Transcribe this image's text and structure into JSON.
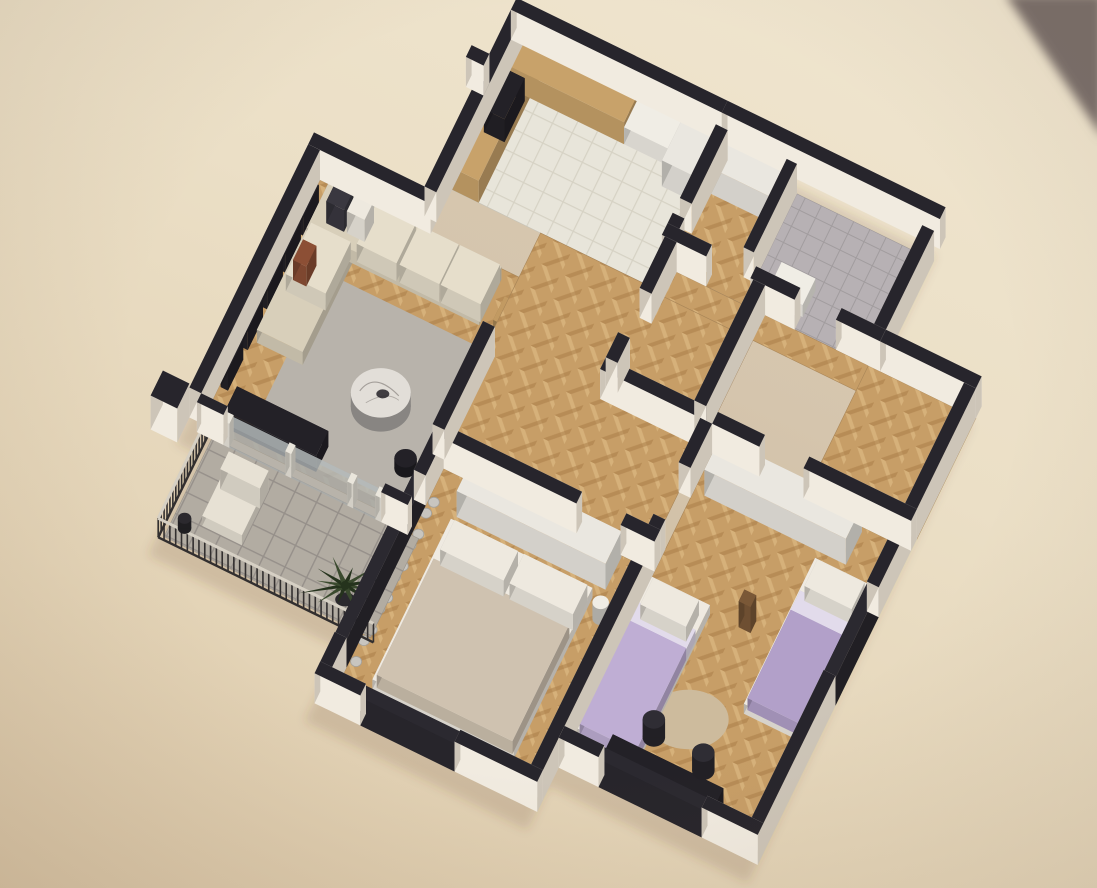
{
  "meta": {
    "visible_text": []
  },
  "palette": {
    "cornerDark": "#796e6a",
    "shadowFill": "rgba(96,70,40,0.16)",
    "wallTop": "#27252c",
    "wallSideL": "#f1ebe0",
    "wallSideD": "#cdc5b8",
    "wood": "#c79e67",
    "woodLight": "#d9b57e",
    "woodDark": "#a97e49",
    "tileKitchen": "#e8e5da",
    "tileKitchenLine": "#d6d2c4",
    "tileBalcony": "#b2aca2",
    "tileBalconyLine": "#96908a",
    "bathFloor": "#b7b1b4",
    "mosaicDark": "#45414a",
    "mosaicLight": "#9b95a0",
    "rug": "#b8b3ab",
    "rugKids": "#cdbb9d",
    "sofa": "#d8cfba",
    "sofaLight": "#e6decb",
    "pillowDark": "#3a3840",
    "pillowWhite": "#eee9df",
    "pillowRust": "#8c4f35",
    "marble": "#e2ded8",
    "marbleVein": "#8a8580",
    "tableWhite": "#f0ede5",
    "chairRattan": "#c29a62",
    "woodCab": "#c8a26a",
    "wardrobe": "#eae7e0",
    "bedSheet": "#efeae1",
    "bedMaster": "#cfc2b0",
    "lilac": "#b2a0c9",
    "lilac2": "#bfaed4",
    "bedKidsBand": "#e2dbeb",
    "curtain": "#c8c5bf",
    "darkFurn": "#232127",
    "chairOffice": "#2f2d34",
    "plantGreen": "#3a4a2e",
    "plantDark": "#25331d",
    "potDark": "#2b292e",
    "lounge": "#e7e1d4",
    "railPost": "#322f2f",
    "railTop": "#d6d0c4",
    "glassFrame": "#2b2930",
    "glassPane": "#b9bfc0",
    "mullion": "#eae6dc",
    "valetBrown": "#7a5837"
  },
  "rooms": [
    {
      "id": "scene",
      "name": "scene"
    },
    {
      "id": "living-room",
      "name": "living-room"
    },
    {
      "id": "dining-area",
      "name": "dining-area"
    },
    {
      "id": "kitchen",
      "name": "kitchen"
    },
    {
      "id": "entry-hall",
      "name": "entry-hall"
    },
    {
      "id": "wc",
      "name": "wc"
    },
    {
      "id": "bathroom",
      "name": "bathroom"
    },
    {
      "id": "hallway",
      "name": "hallway"
    },
    {
      "id": "master-bedroom",
      "name": "master-bedroom"
    },
    {
      "id": "kids-bedroom",
      "name": "kids-bedroom"
    },
    {
      "id": "balcony",
      "name": "balcony"
    },
    {
      "id": "walls",
      "name": "walls"
    }
  ],
  "elements": [
    {
      "id": "photo-corner",
      "name": "photo-background-corner",
      "room": "scene",
      "fill": "cornerDark"
    },
    {
      "id": "building-shadow",
      "name": "building-drop-shadow",
      "room": "scene",
      "fill": "shadowFill"
    },
    {
      "id": "floor-living",
      "name": "living-room-floor",
      "room": "living-room",
      "fill": "wood"
    },
    {
      "id": "floor-hall",
      "name": "hallway-floor",
      "room": "hallway",
      "fill": "wood"
    },
    {
      "id": "floor-hall-upper",
      "name": "upper-hall-floor",
      "room": "hallway",
      "fill": "wood"
    },
    {
      "id": "floor-vestibule",
      "name": "vestibule-floor",
      "room": "hallway",
      "fill": "wood"
    },
    {
      "id": "floor-kitchen",
      "name": "kitchen-floor",
      "room": "kitchen",
      "fill": "tileKitchen"
    },
    {
      "id": "floor-entry-closet",
      "name": "entry-closet-floor",
      "room": "entry-hall",
      "fill": "wood"
    },
    {
      "id": "floor-entry-wc",
      "name": "wc-floor",
      "room": "wc",
      "fill": "bathFloor"
    },
    {
      "id": "floor-bathroom",
      "name": "bathroom-floor",
      "room": "bathroom",
      "fill": "bathFloor"
    },
    {
      "id": "floor-shower",
      "name": "shower-mosaic-floor",
      "room": "bathroom",
      "fill": "mosaicDark"
    },
    {
      "id": "floor-master",
      "name": "master-bedroom-floor",
      "room": "master-bedroom",
      "fill": "wood"
    },
    {
      "id": "floor-kids",
      "name": "kids-bedroom-floor",
      "room": "kids-bedroom",
      "fill": "wood"
    },
    {
      "id": "floor-balcony",
      "name": "balcony-floor",
      "room": "balcony",
      "fill": "tileBalcony"
    },
    {
      "id": "balcony-railing",
      "name": "balcony-railing",
      "room": "balcony",
      "fill": "railPost"
    },
    {
      "id": "lounge-chair-base",
      "name": "balcony-lounge-chair",
      "room": "balcony",
      "fill": "lounge"
    },
    {
      "id": "lounge-chair-back",
      "name": "balcony-lounge-chair-back",
      "room": "balcony",
      "fill": "lounge"
    },
    {
      "id": "balcony-pot",
      "name": "balcony-plant-pot",
      "room": "balcony",
      "fill": "potDark"
    },
    {
      "id": "palm-plant",
      "name": "palm-plant",
      "room": "balcony",
      "fill": "plantGreen"
    },
    {
      "id": "living-rug",
      "name": "living-room-rug",
      "room": "living-room",
      "fill": "rug"
    },
    {
      "id": "gallery-shelf-1",
      "name": "wall-gallery-shelf",
      "room": "living-room",
      "fill": "darkFurn"
    },
    {
      "id": "gallery-shelf-2",
      "name": "wall-gallery-shelf",
      "room": "living-room",
      "fill": "darkFurn"
    },
    {
      "id": "gallery-shelf-3",
      "name": "wall-gallery-shelf",
      "room": "living-room",
      "fill": "darkFurn"
    },
    {
      "id": "gallery-shelf-4",
      "name": "wall-gallery-shelf",
      "room": "living-room",
      "fill": "darkFurn"
    },
    {
      "id": "gallery-shelf-5",
      "name": "wall-gallery-shelf",
      "room": "living-room",
      "fill": "darkFurn"
    },
    {
      "id": "sofa-chaise",
      "name": "sofa-chaise",
      "room": "living-room",
      "fill": "sofa"
    },
    {
      "id": "sofa-main",
      "name": "sofa",
      "room": "living-room",
      "fill": "sofa"
    },
    {
      "id": "sofa-cushion-1",
      "name": "sofa-cushion",
      "room": "living-room",
      "fill": "sofaLight"
    },
    {
      "id": "sofa-cushion-2",
      "name": "sofa-cushion",
      "room": "living-room",
      "fill": "sofaLight"
    },
    {
      "id": "sofa-cushion-3",
      "name": "sofa-cushion",
      "room": "living-room",
      "fill": "sofaLight"
    },
    {
      "id": "sofa-cushion-4",
      "name": "sofa-cushion",
      "room": "living-room",
      "fill": "sofaLight"
    },
    {
      "id": "pillow-dark",
      "name": "throw-pillow-dark",
      "room": "living-room",
      "fill": "pillowDark"
    },
    {
      "id": "pillow-white",
      "name": "throw-pillow-white",
      "room": "living-room",
      "fill": "pillowWhite"
    },
    {
      "id": "pillow-rust",
      "name": "throw-pillow-rust",
      "room": "living-room",
      "fill": "pillowRust"
    },
    {
      "id": "coffee-table-marble",
      "name": "round-marble-coffee-table",
      "room": "living-room",
      "fill": "marble"
    },
    {
      "id": "side-table",
      "name": "side-table",
      "room": "living-room",
      "fill": "darkFurn"
    },
    {
      "id": "tv-console",
      "name": "tv-console",
      "room": "living-room",
      "fill": "darkFurn"
    },
    {
      "id": "dining-table",
      "name": "dining-table",
      "room": "dining-area",
      "fill": "tableWhite"
    },
    {
      "id": "dining-chair-1",
      "name": "dining-chair",
      "room": "dining-area",
      "fill": "chairRattan"
    },
    {
      "id": "dining-chair-2",
      "name": "dining-chair",
      "room": "dining-area",
      "fill": "chairRattan"
    },
    {
      "id": "dining-chair-3",
      "name": "dining-chair",
      "room": "dining-area",
      "fill": "chairRattan"
    },
    {
      "id": "dining-chair-4",
      "name": "dining-chair",
      "room": "dining-area",
      "fill": "chairRattan"
    },
    {
      "id": "dining-decor",
      "name": "table-centerpiece",
      "room": "dining-area",
      "fill": "woodCab"
    },
    {
      "id": "tv-screen",
      "name": "wall-tv",
      "room": "dining-area",
      "fill": "darkFurn"
    },
    {
      "id": "kitchen-cabinet-left",
      "name": "kitchen-cabinets",
      "room": "kitchen",
      "fill": "woodCab"
    },
    {
      "id": "kitchen-cabinet-top",
      "name": "kitchen-cabinets",
      "room": "kitchen",
      "fill": "woodCab"
    },
    {
      "id": "kitchen-counter",
      "name": "kitchen-counter",
      "room": "kitchen",
      "fill": "tableWhite"
    },
    {
      "id": "kitchen-tall-cabinet",
      "name": "kitchen-tall-cabinet",
      "room": "kitchen",
      "fill": "wardrobe"
    },
    {
      "id": "kitchen-cooktop",
      "name": "kitchen-cooktop",
      "room": "kitchen",
      "fill": "darkFurn"
    },
    {
      "id": "entry-wardrobe",
      "name": "entry-wardrobe",
      "room": "entry-hall",
      "fill": "wardrobe"
    },
    {
      "id": "entry-wc-fixture",
      "name": "wc-fixture",
      "room": "wc",
      "fill": "tableWhite"
    },
    {
      "id": "shower-partition",
      "name": "shower-glass-partition",
      "room": "bathroom",
      "fill": "glassPane"
    },
    {
      "id": "toilet",
      "name": "toilet",
      "room": "bathroom",
      "fill": "tableWhite"
    },
    {
      "id": "bathroom-vanity",
      "name": "bathroom-vanity",
      "room": "bathroom",
      "fill": "tableWhite"
    },
    {
      "id": "master-wardrobe",
      "name": "master-wardrobe",
      "room": "master-bedroom",
      "fill": "wardrobe"
    },
    {
      "id": "master-bed-base",
      "name": "double-bed",
      "room": "master-bedroom",
      "fill": "bedSheet"
    },
    {
      "id": "master-bed-blanket",
      "name": "double-bed-blanket",
      "room": "master-bedroom",
      "fill": "bedMaster"
    },
    {
      "id": "master-pillow-1",
      "name": "bed-pillow",
      "room": "master-bedroom",
      "fill": "pillowWhite"
    },
    {
      "id": "master-pillow-2",
      "name": "bed-pillow",
      "room": "master-bedroom",
      "fill": "pillowWhite"
    },
    {
      "id": "master-bedside-lamp",
      "name": "bedside-lamp",
      "room": "master-bedroom",
      "fill": "tableWhite"
    },
    {
      "id": "master-curtains",
      "name": "window-curtains",
      "room": "master-bedroom",
      "fill": "curtain"
    },
    {
      "id": "kids-rug",
      "name": "kids-round-rug",
      "room": "kids-bedroom",
      "fill": "rugKids"
    },
    {
      "id": "kids-wardrobe",
      "name": "kids-wardrobe",
      "room": "kids-bedroom",
      "fill": "wardrobe"
    },
    {
      "id": "kids-bed-right-base",
      "name": "single-bed",
      "room": "kids-bedroom",
      "fill": "bedSheet"
    },
    {
      "id": "kids-bed-right-band",
      "name": "single-bed-sheet-band",
      "room": "kids-bedroom",
      "fill": "bedKidsBand"
    },
    {
      "id": "kids-bed-right-blanket",
      "name": "single-bed-blanket-lilac",
      "room": "kids-bedroom",
      "fill": "lilac"
    },
    {
      "id": "kids-bed-right-pillow",
      "name": "bed-pillow",
      "room": "kids-bedroom",
      "fill": "pillowWhite"
    },
    {
      "id": "kids-bed-left-base",
      "name": "single-bed",
      "room": "kids-bedroom",
      "fill": "bedSheet"
    },
    {
      "id": "kids-bed-left-band",
      "name": "single-bed-sheet-band",
      "room": "kids-bedroom",
      "fill": "bedKidsBand"
    },
    {
      "id": "kids-bed-left-blanket",
      "name": "single-bed-blanket-lilac",
      "room": "kids-bedroom",
      "fill": "lilac2"
    },
    {
      "id": "kids-bed-left-pillow",
      "name": "bed-pillow",
      "room": "kids-bedroom",
      "fill": "pillowWhite"
    },
    {
      "id": "kids-desk",
      "name": "desk",
      "room": "kids-bedroom",
      "fill": "darkFurn"
    },
    {
      "id": "kids-chair-1",
      "name": "office-chair",
      "room": "kids-bedroom",
      "fill": "chairOffice"
    },
    {
      "id": "kids-chair-2",
      "name": "office-chair",
      "room": "kids-bedroom",
      "fill": "chairOffice"
    },
    {
      "id": "kids-valet",
      "name": "valet-stand",
      "room": "kids-bedroom",
      "fill": "valetBrown"
    },
    {
      "id": "window-kids-right",
      "name": "window",
      "room": "walls",
      "fill": "glassFrame"
    },
    {
      "id": "window-master-left",
      "name": "window",
      "room": "walls",
      "fill": "glassFrame"
    },
    {
      "id": "window-master-bottom",
      "name": "window",
      "room": "walls",
      "fill": "glassFrame"
    },
    {
      "id": "window-kids-desk",
      "name": "window",
      "room": "walls",
      "fill": "glassFrame"
    },
    {
      "id": "glass-door-pane",
      "name": "balcony-sliding-glass-door",
      "room": "walls",
      "fill": "glassPane"
    },
    {
      "id": "glass-door-mullion-1",
      "name": "glass-door-mullion",
      "room": "walls",
      "fill": "mullion"
    },
    {
      "id": "glass-door-mullion-2",
      "name": "glass-door-mullion",
      "room": "walls",
      "fill": "mullion"
    },
    {
      "id": "glass-door-mullion-3",
      "name": "glass-door-mullion",
      "room": "walls",
      "fill": "mullion"
    },
    {
      "id": "glass-door-mullion-4",
      "name": "glass-door-mullion",
      "room": "walls",
      "fill": "mullion"
    },
    {
      "id": "wall-living-top",
      "name": "exterior-wall",
      "room": "walls",
      "fill": "wallTop"
    },
    {
      "id": "wall-living-left",
      "name": "exterior-wall",
      "room": "walls",
      "fill": "wallTop"
    },
    {
      "id": "wall-kitchen-left",
      "name": "exterior-wall",
      "room": "walls",
      "fill": "wallTop"
    },
    {
      "id": "wall-kitchen-stub",
      "name": "exterior-wall-stub",
      "room": "walls",
      "fill": "wallTop"
    },
    {
      "id": "wall-kitchen-top",
      "name": "exterior-wall",
      "room": "walls",
      "fill": "wallTop"
    },
    {
      "id": "wall-entry-top",
      "name": "exterior-wall",
      "room": "walls",
      "fill": "wallTop"
    },
    {
      "id": "wall-entry-left-a",
      "name": "interior-wall",
      "room": "walls",
      "fill": "wallTop"
    },
    {
      "id": "wall-entry-left-b",
      "name": "interior-wall",
      "room": "walls",
      "fill": "wallTop"
    },
    {
      "id": "wall-entry-divider",
      "name": "interior-wall",
      "room": "walls",
      "fill": "wallTop"
    },
    {
      "id": "wall-entry-right",
      "name": "exterior-wall",
      "room": "walls",
      "fill": "wallTop"
    },
    {
      "id": "wall-entry-band-1",
      "name": "interior-wall",
      "room": "walls",
      "fill": "wallTop"
    },
    {
      "id": "wall-entry-band-2",
      "name": "interior-wall",
      "room": "walls",
      "fill": "wallTop"
    },
    {
      "id": "wall-entry-band-3",
      "name": "interior-wall",
      "room": "walls",
      "fill": "wallTop"
    },
    {
      "id": "wall-vestibule-top",
      "name": "exterior-wall",
      "room": "walls",
      "fill": "wallTop"
    },
    {
      "id": "wall-right-upper",
      "name": "exterior-wall",
      "room": "walls",
      "fill": "wallTop"
    },
    {
      "id": "wall-right-lower",
      "name": "exterior-wall",
      "room": "walls",
      "fill": "wallTop"
    },
    {
      "id": "wall-bath-band-1",
      "name": "interior-wall",
      "room": "walls",
      "fill": "wallTop"
    },
    {
      "id": "wall-bath-band-2",
      "name": "interior-wall",
      "room": "walls",
      "fill": "wallTop"
    },
    {
      "id": "wall-bath-left-a",
      "name": "interior-wall",
      "room": "walls",
      "fill": "wallTop"
    },
    {
      "id": "wall-bath-left-b",
      "name": "interior-wall",
      "room": "walls",
      "fill": "wallTop"
    },
    {
      "id": "wall-bath-right",
      "name": "interior-wall",
      "room": "walls",
      "fill": "wallTop"
    },
    {
      "id": "wall-divider-a",
      "name": "interior-wall",
      "room": "walls",
      "fill": "wallTop"
    },
    {
      "id": "wall-divider-b",
      "name": "interior-wall",
      "room": "walls",
      "fill": "wallTop"
    },
    {
      "id": "wall-master-top-a",
      "name": "interior-wall",
      "room": "walls",
      "fill": "wallTop"
    },
    {
      "id": "wall-master-top-b",
      "name": "interior-wall",
      "room": "walls",
      "fill": "wallTop"
    },
    {
      "id": "wall-master-left-a",
      "name": "exterior-wall",
      "room": "walls",
      "fill": "wallTop"
    },
    {
      "id": "wall-master-left-b",
      "name": "exterior-wall",
      "room": "walls",
      "fill": "wallTop"
    },
    {
      "id": "wall-master-bottom-a",
      "name": "exterior-wall",
      "room": "walls",
      "fill": "wallTop"
    },
    {
      "id": "wall-master-bottom-b",
      "name": "exterior-wall",
      "room": "walls",
      "fill": "wallTop"
    },
    {
      "id": "wall-kids-bottom-a",
      "name": "exterior-wall",
      "room": "walls",
      "fill": "wallTop"
    },
    {
      "id": "wall-kids-bottom-b",
      "name": "exterior-wall",
      "room": "walls",
      "fill": "wallTop"
    },
    {
      "id": "wall-tv-stub",
      "name": "tv-partition-wall",
      "room": "walls",
      "fill": "wallTop"
    },
    {
      "id": "wall-glass-stub-1",
      "name": "exterior-wall",
      "room": "walls",
      "fill": "wallTop"
    },
    {
      "id": "wall-glass-stub-2",
      "name": "exterior-wall",
      "room": "walls",
      "fill": "wallTop"
    },
    {
      "id": "wall-pillar",
      "name": "balcony-pillar",
      "room": "walls",
      "fill": "wallTop"
    }
  ]
}
